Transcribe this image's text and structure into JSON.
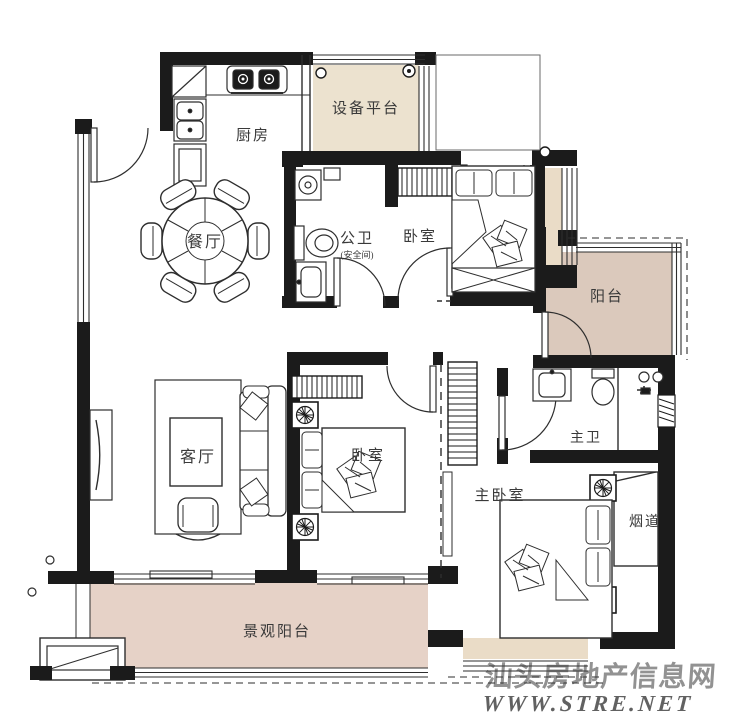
{
  "plan_title": "apartment floor plan",
  "rooms": {
    "kitchen": {
      "label": "厨房"
    },
    "equipment_platform": {
      "label": "设备平台"
    },
    "dining": {
      "label": "餐厅"
    },
    "public_bath": {
      "label": "公卫",
      "sublabel": "(安全间)"
    },
    "bedroom_top": {
      "label": "卧室"
    },
    "balcony": {
      "label": "阳台"
    },
    "living": {
      "label": "客厅"
    },
    "bedroom_mid": {
      "label": "卧室"
    },
    "master_bath": {
      "label": "主卫"
    },
    "master_bedroom": {
      "label": "主卧室"
    },
    "flue": {
      "label": "烟道"
    },
    "view_balcony": {
      "label": "景观阳台"
    }
  },
  "watermark": {
    "line1": "汕头房地产信息网",
    "line2": "WWW.STRE.NET",
    "color_line1": "#cb4a42",
    "color_line2": "#eb9d96"
  },
  "colors": {
    "wall": "#1b1b1b",
    "line": "#2e2e2e",
    "platform_fill": "#ece2cf",
    "balcony_fill": "#dbc9bc",
    "view_balcony_fill": "#e6d2c7",
    "bay_fill": "#eadcc7"
  }
}
